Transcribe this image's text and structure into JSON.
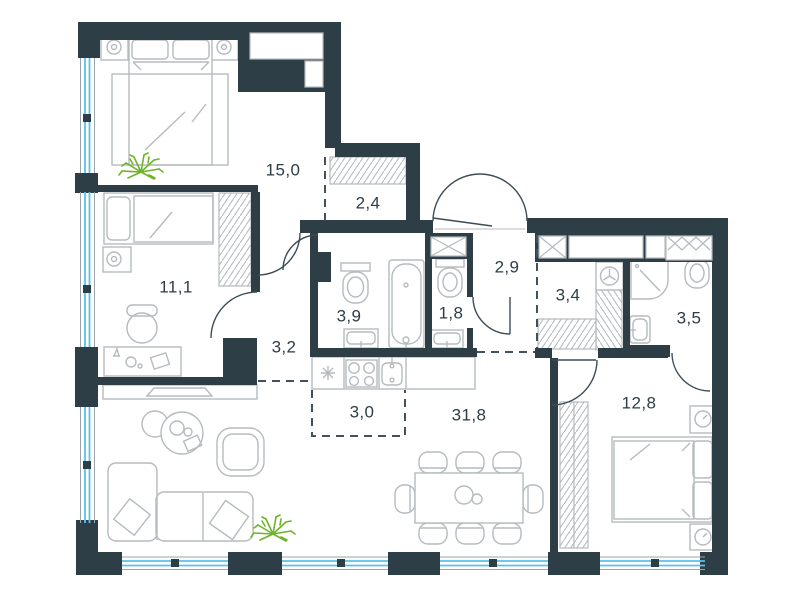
{
  "floor_plan": {
    "rooms": [
      {
        "name": "bedroom-main",
        "area_label": "15,0"
      },
      {
        "name": "wardrobe-bedroom-main",
        "area_label": "2,4"
      },
      {
        "name": "bedroom-second",
        "area_label": "11,1"
      },
      {
        "name": "inner-hallway",
        "area_label": "3,2"
      },
      {
        "name": "bathroom-main",
        "area_label": "3,9"
      },
      {
        "name": "wc",
        "area_label": "1,8"
      },
      {
        "name": "entrance-hall",
        "area_label": "2,9"
      },
      {
        "name": "walkthrough-wardrobe",
        "area_label": "3,4"
      },
      {
        "name": "bathroom-second",
        "area_label": "3,5"
      },
      {
        "name": "kitchen-zone",
        "area_label": "3,0"
      },
      {
        "name": "living-dining-room",
        "area_label": "31,8"
      },
      {
        "name": "bedroom-third",
        "area_label": "12,8"
      }
    ],
    "colors": {
      "wall": "#2d3e46",
      "furniture_outline": "#b5bbbe",
      "window_glass": "#5ac1ec",
      "plant": "#6fb32a",
      "room_label": "#2c3d46",
      "open_boundary_dash": "#40525a",
      "background": "#ffffff"
    }
  }
}
